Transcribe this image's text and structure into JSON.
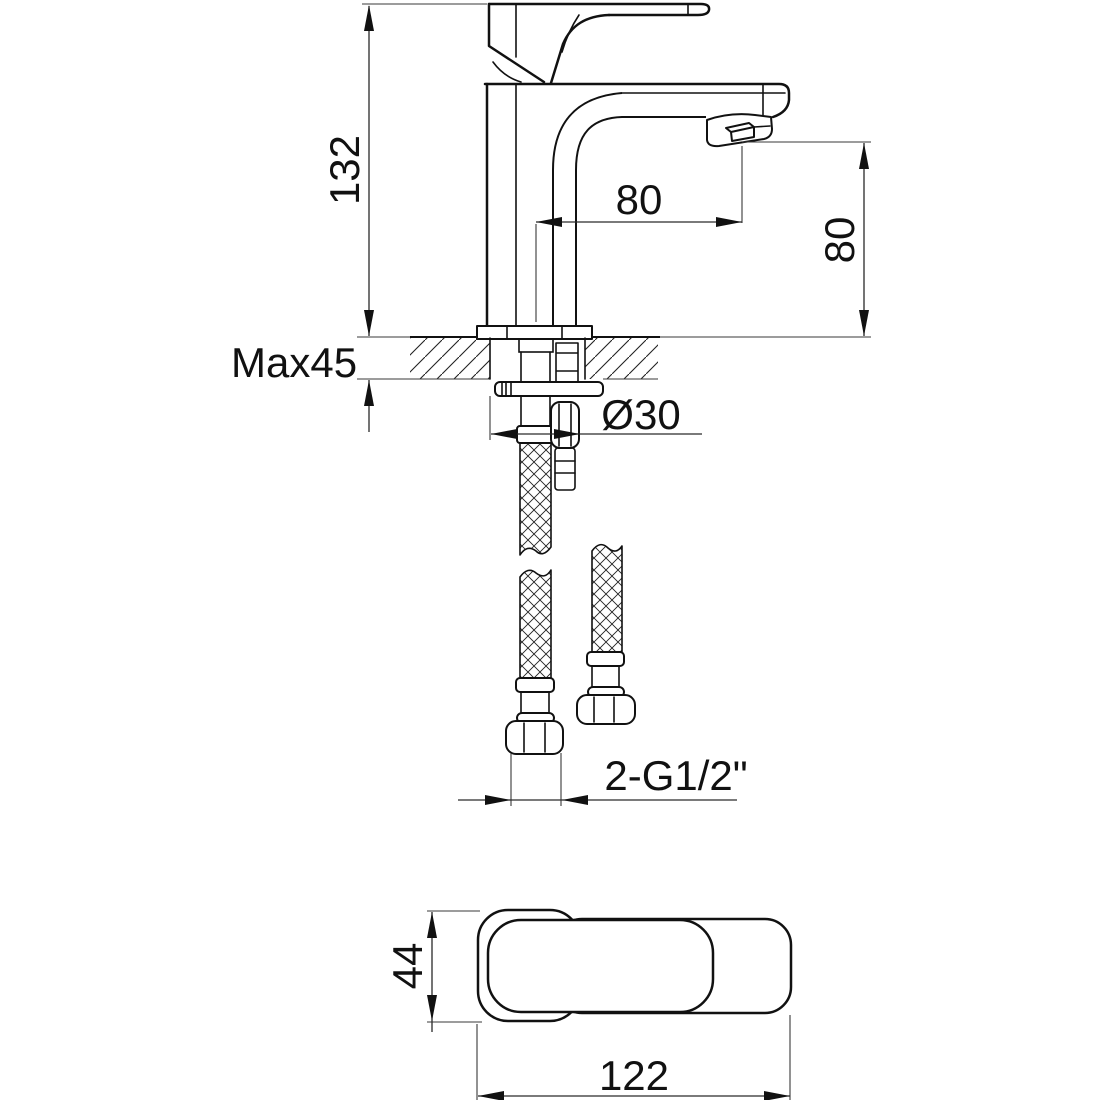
{
  "drawing": {
    "colors": {
      "line": "#111111",
      "background": "#ffffff"
    },
    "dimensions": {
      "overall_height": "132",
      "max_deck_thickness": "Max45",
      "spout_reach": "80",
      "spout_height": "80",
      "shank_diameter": "Ø30",
      "thread_connections": "2-G1/2\"",
      "top_view_depth": "44",
      "top_view_length": "122"
    }
  }
}
